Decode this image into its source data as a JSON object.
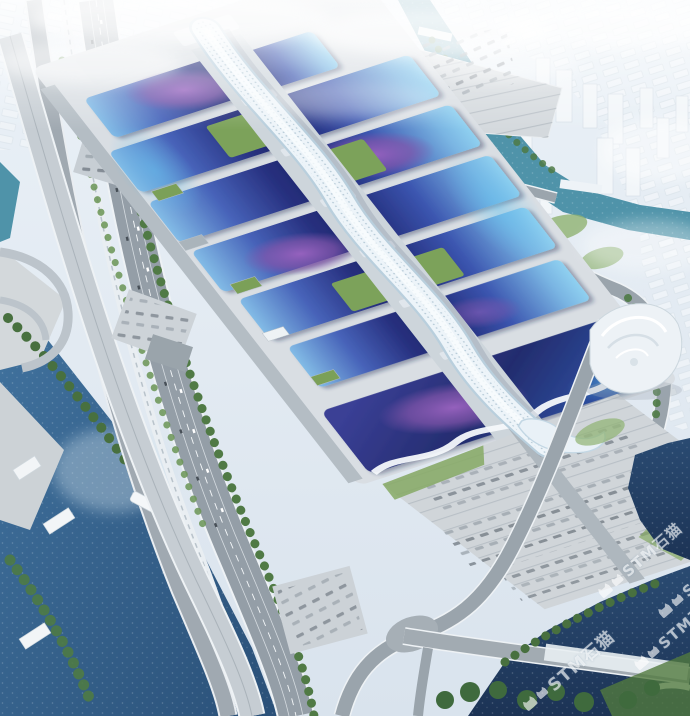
{
  "image": {
    "type": "aerial-architectural-rendering",
    "description": "Bird's-eye architectural rendering of a huge exhibition and convention center: paired rows of blue, cyan and purple vaulted exhibition halls flank a white serpentine central concourse ribbon; surrounded by multi-lane roads, an elevated expressway, parking lots with vehicles, canals and rivers, green trees, plazas, a white spiral-shaped building and a hazy white city skyline.",
    "watermark": {
      "logo_icon": "cat-logo-icon",
      "text": "STM石猫",
      "color": "#ffffff",
      "opacity": 0.62,
      "rotation_deg": -41,
      "instances": 4
    },
    "palette": {
      "hall_roof_navy": "#27307f",
      "hall_roof_cyan": "#7fb9e5",
      "hall_roof_purple": "#8456ac",
      "concourse_white": "#eef5fa",
      "river_blue": "#2b5480",
      "river_dark": "#1d3658",
      "canal_teal": "#4f93a9",
      "road_gray": "#98a2ab",
      "parking_gray": "#d3d8dc",
      "tree_green": "#4e7a43",
      "lawn_green": "#83a862",
      "city_haze": "#eef3f7"
    }
  }
}
